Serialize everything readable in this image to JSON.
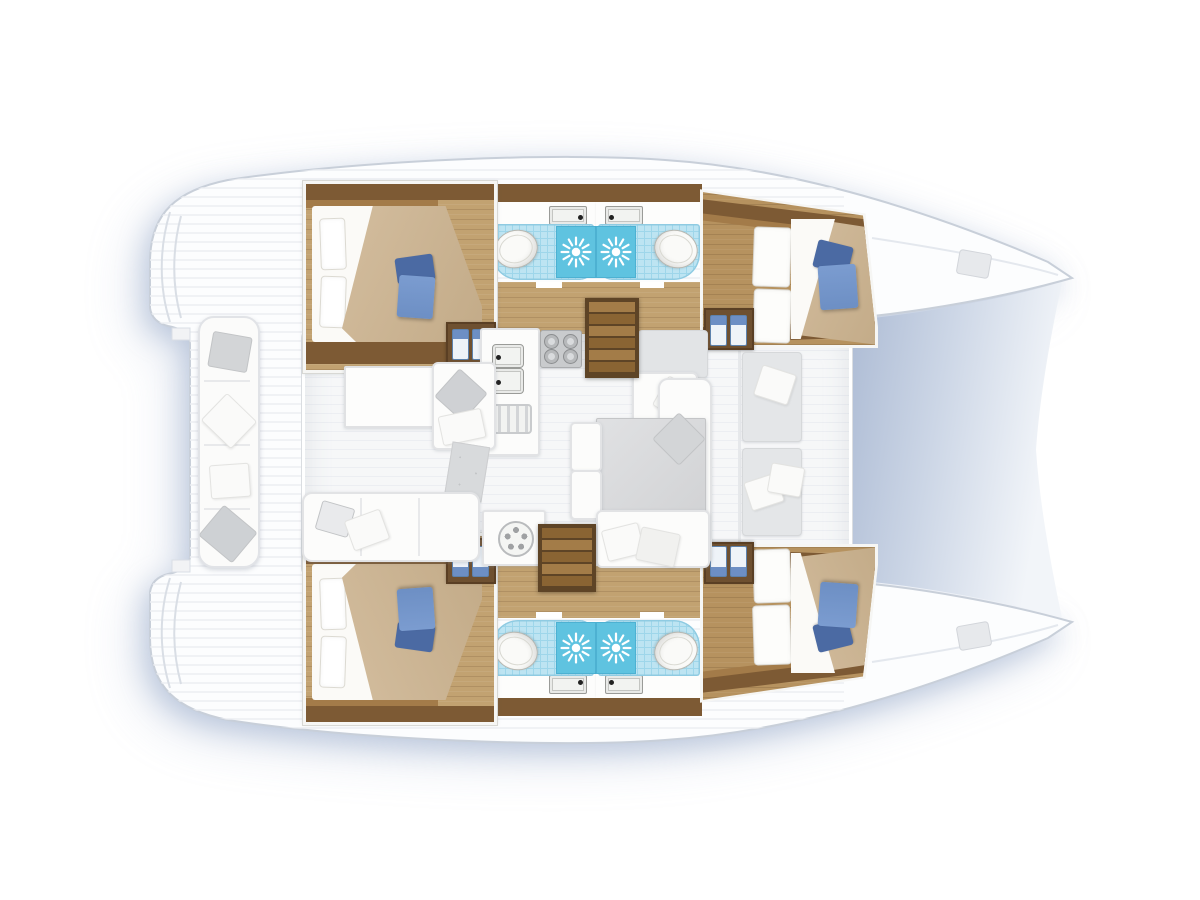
{
  "diagram": {
    "kind": "catamaran-yacht-floor-plan",
    "view": "top-down deck and interior layout, bow pointing right",
    "text_on_image": "none"
  },
  "palette": {
    "deck": "#f6f7f8",
    "deck_line": "#eceef2",
    "hull_fill": "#fcfdfe",
    "hull_stroke": "#c8cfd9",
    "shadow": "#92a5c6",
    "tramp_dark": "#a9b8d2",
    "tramp_mid": "#ccd6e6",
    "tramp_light": "#f2f5f9",
    "wood": "#c2a271",
    "wood_mid": "#b6925f",
    "wood_dark": "#7d5a34",
    "wood_shelf": "#a37b49",
    "wood_deep": "#6e5030",
    "stair_dark": "#8a6433",
    "stair_light": "#a37c48",
    "stair_border": "#5e4426",
    "blanket": "#d3bd9e",
    "blanket_dark": "#c3ab88",
    "sheet": "#fbfaf7",
    "pillow_border": "#dcdad2",
    "blue_dark": "#4b6aa3",
    "blue_mid": "#6d8fc4",
    "blue_light": "#7b9cd0",
    "tile": "#bde4f2",
    "tile_grid": "#9ed6ea",
    "shower": "#5fc3e0",
    "shower_border": "#4db1d2",
    "porcelain": "#fafaf8",
    "porcelain_border": "#b8b8b2",
    "white_furn": "#fcfcfb",
    "furn_border": "#e2e3e5",
    "grey_furn": "#e4e6e8",
    "grey_mid": "#d3d5d7",
    "table_grey": "#d8d9db",
    "steel": "#c9cbcd",
    "steel_dark": "#9a9b98"
  },
  "rooms": [
    {
      "name": "aft-cabin-port",
      "items": [
        "double-bed",
        "white-pillows",
        "blue-accent-pillow",
        "wardrobe-locker"
      ]
    },
    {
      "name": "forward-cabin-port",
      "items": [
        "double-bed",
        "blue-accent-pillows",
        "locker-doors",
        "wardrobe-locker"
      ]
    },
    {
      "name": "aft-cabin-starboard",
      "items": [
        "double-bed",
        "white-pillows",
        "blue-accent-pillow",
        "wardrobe-locker"
      ]
    },
    {
      "name": "forward-cabin-starboard",
      "items": [
        "double-bed",
        "blue-accent-pillows",
        "locker-doors",
        "wardrobe-locker"
      ]
    },
    {
      "name": "bathroom-port-aft",
      "items": [
        "toilet",
        "shower",
        "washbasin"
      ]
    },
    {
      "name": "bathroom-port-forward",
      "items": [
        "toilet",
        "shower",
        "washbasin"
      ]
    },
    {
      "name": "bathroom-starboard-aft",
      "items": [
        "toilet",
        "shower",
        "washbasin"
      ]
    },
    {
      "name": "bathroom-starboard-forward",
      "items": [
        "toilet",
        "shower",
        "washbasin"
      ]
    },
    {
      "name": "saloon",
      "items": [
        "galley-stove-four-burners",
        "double-sink",
        "fridge-grille",
        "galley-aft-unit",
        "coffee-table",
        "lounge-seat",
        "rug",
        "aft-sofa",
        "dining-table",
        "dining-seats",
        "cushions"
      ]
    },
    {
      "name": "cockpit",
      "items": [
        "bench-with-cushions",
        "teak-deck",
        "transom-steps"
      ]
    },
    {
      "name": "foredeck",
      "items": [
        "trampoline",
        "two-lounge-seats",
        "bow-deck-hatches"
      ]
    }
  ],
  "companionways": {
    "count": 2,
    "description": "wooden steps from saloon down into each hull"
  }
}
